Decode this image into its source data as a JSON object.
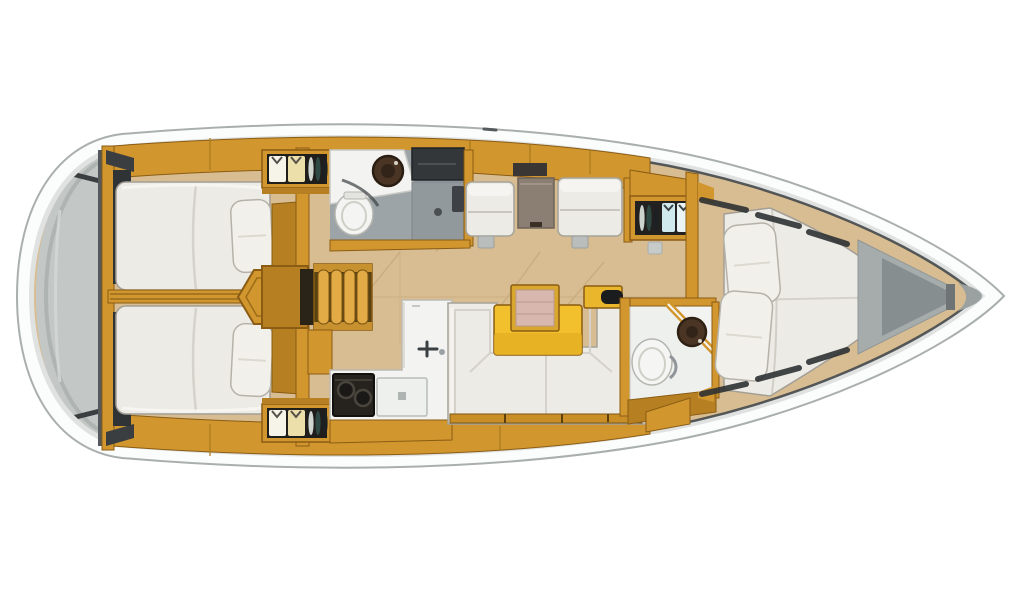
{
  "image": {
    "type": "yacht-interior-floor-plan",
    "subject": "Top-down deck plan of a sailing yacht interior, bow pointing right, stern (rounded transom) at left",
    "visible_text": "none"
  },
  "palette": {
    "bg": "#ffffff",
    "hullFill": "#fbfcfc",
    "hullStroke": "#a9aeae",
    "hullShade": "#dfe2e1",
    "toeRail": "#45494c",
    "transom": "#c3c8c6",
    "transomShade": "#a9afac",
    "wood": "#d2962e",
    "woodLight": "#e3ab45",
    "woodDeep": "#b67f22",
    "woodDark": "#8a5c14",
    "tableYellow": "#f2c02c",
    "floorTan": "#d8bd92",
    "floorSeam": "#bfa171",
    "mattress": "#edebe5",
    "mattressShade": "#d4d2cb",
    "mattressStroke": "#a39f96",
    "pillow": "#f2f0ea",
    "counterWhite": "#f3f3f1",
    "headFloor": "#9da4a8",
    "showerFloor": "#92999d",
    "darkLocker": "#2f3336",
    "darkest": "#1c1d1e",
    "sinkBrown": "#4a3423",
    "shirtWhite": "#f6f3e9",
    "shirtCream": "#ecdfa9",
    "shirtBlue": "#cfe9ec",
    "tableGray": "#8b7e73",
    "pinkLeaf": "#d7b7ae",
    "bowWedge": "#a6acac",
    "bowWedgeDark": "#878e90",
    "hatchDark": "#2e3234"
  },
  "rooms": [
    {
      "id": "transom",
      "label": "stern swim platform"
    },
    {
      "id": "aft-cabin-top",
      "label": "aft double cabin (port)",
      "features": [
        "double-berth",
        "pillow",
        "side-locker"
      ]
    },
    {
      "id": "aft-cabin-bottom",
      "label": "aft double cabin (starboard)",
      "features": [
        "double-berth",
        "pillow",
        "side-locker"
      ]
    },
    {
      "id": "companionway",
      "label": "companionway steps"
    },
    {
      "id": "aft-head",
      "label": "aft head",
      "features": [
        "toilet",
        "washbasin",
        "shower-stall"
      ]
    },
    {
      "id": "galley",
      "label": "galley",
      "features": [
        "two-burner-stove",
        "sink-and-faucet",
        "refrigerator"
      ]
    },
    {
      "id": "saloon",
      "label": "saloon",
      "features": [
        "u-shaped-settee",
        "dining-table-with-leaf",
        "two-armchairs",
        "side-table"
      ]
    },
    {
      "id": "wardrobes",
      "label": "hanging lockers",
      "features": [
        "hangers-with-garments",
        "shelved-discs"
      ]
    },
    {
      "id": "forward-head",
      "label": "forward head",
      "features": [
        "toilet",
        "round-washbasin"
      ]
    },
    {
      "id": "forward-cabin",
      "label": "forward V-berth cabin",
      "features": [
        "v-berth",
        "two-pillows"
      ]
    },
    {
      "id": "bow-locker",
      "label": "bow anchor locker"
    }
  ]
}
